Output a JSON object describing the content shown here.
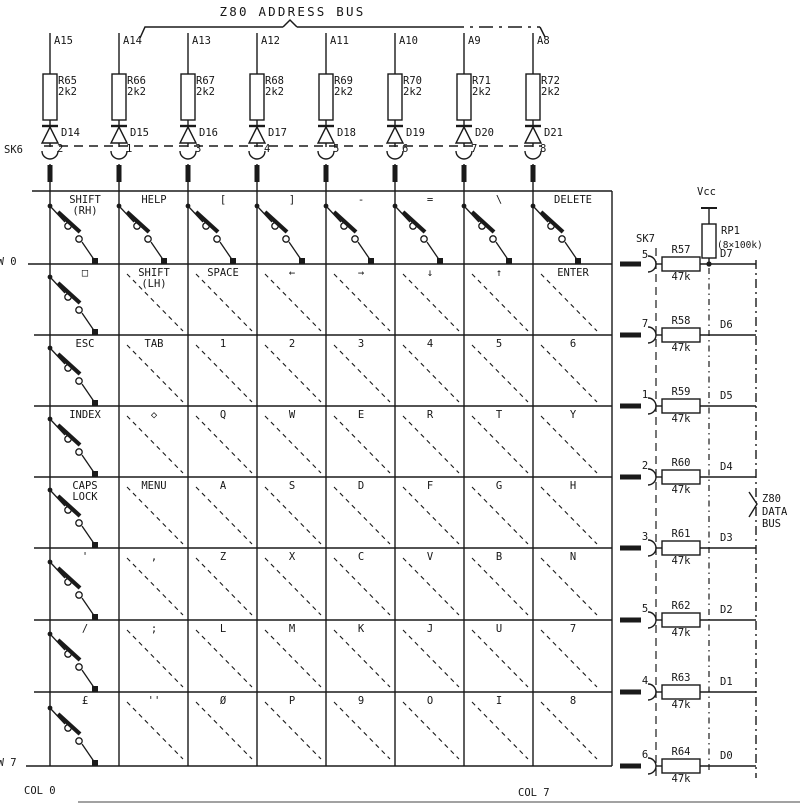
{
  "title": "Z80 ADDRESS BUS",
  "data_bus_label": "Z80\nDATA\nBUS",
  "labels": {
    "sk6": "SK6",
    "sk7": "SK7",
    "vcc": "Vcc",
    "rp1": "RP1",
    "rp1_value": "(8×100k)",
    "row0": "ROW 0",
    "row7": "ROW 7",
    "col0": "COL 0",
    "col7": "COL 7"
  },
  "address_columns": [
    {
      "line": "A15",
      "resistor": "R65",
      "value": "2k2",
      "diode": "D14",
      "pin": "2"
    },
    {
      "line": "A14",
      "resistor": "R66",
      "value": "2k2",
      "diode": "D15",
      "pin": "1"
    },
    {
      "line": "A13",
      "resistor": "R67",
      "value": "2k2",
      "diode": "D16",
      "pin": "3"
    },
    {
      "line": "A12",
      "resistor": "R68",
      "value": "2k2",
      "diode": "D17",
      "pin": "4"
    },
    {
      "line": "A11",
      "resistor": "R69",
      "value": "2k2",
      "diode": "D18",
      "pin": "5"
    },
    {
      "line": "A10",
      "resistor": "R70",
      "value": "2k2",
      "diode": "D19",
      "pin": "6"
    },
    {
      "line": "A9",
      "resistor": "R71",
      "value": "2k2",
      "diode": "D20",
      "pin": "7"
    },
    {
      "line": "A8",
      "resistor": "R72",
      "value": "2k2",
      "diode": "D21",
      "pin": "8"
    }
  ],
  "matrix": {
    "rows": [
      {
        "keys": [
          "SHIFT\n(RH)",
          "HELP",
          "[",
          "]",
          "-",
          "=",
          "\\",
          "DELETE"
        ],
        "pin": "5",
        "resistor": "R57",
        "value": "47k",
        "data_line": "D7"
      },
      {
        "keys": [
          "□",
          "SHIFT\n(LH)",
          "SPACE",
          "←",
          "→",
          "↓",
          "↑",
          "ENTER"
        ],
        "pin": "7",
        "resistor": "R58",
        "value": "47k",
        "data_line": "D6"
      },
      {
        "keys": [
          "ESC",
          "TAB",
          "1",
          "2",
          "3",
          "4",
          "5",
          "6"
        ],
        "pin": "1",
        "resistor": "R59",
        "value": "47k",
        "data_line": "D5"
      },
      {
        "keys": [
          "INDEX",
          "◇",
          "Q",
          "W",
          "E",
          "R",
          "T",
          "Y"
        ],
        "pin": "2",
        "resistor": "R60",
        "value": "47k",
        "data_line": "D4"
      },
      {
        "keys": [
          "CAPS\nLOCK",
          "MENU",
          "A",
          "S",
          "D",
          "F",
          "G",
          "H"
        ],
        "pin": "3",
        "resistor": "R61",
        "value": "47k",
        "data_line": "D3"
      },
      {
        "keys": [
          "'",
          ",",
          "Z",
          "X",
          "C",
          "V",
          "B",
          "N"
        ],
        "pin": "5",
        "resistor": "R62",
        "value": "47k",
        "data_line": "D2"
      },
      {
        "keys": [
          "/",
          ";",
          "L",
          "M",
          "K",
          "J",
          "U",
          "7"
        ],
        "pin": "4",
        "resistor": "R63",
        "value": "47k",
        "data_line": "D1"
      },
      {
        "keys": [
          "£",
          "''",
          "Ø",
          "P",
          "9",
          "O",
          "I",
          "8"
        ],
        "pin": "6",
        "resistor": "R64",
        "value": "47k",
        "data_line": "D0"
      }
    ]
  }
}
